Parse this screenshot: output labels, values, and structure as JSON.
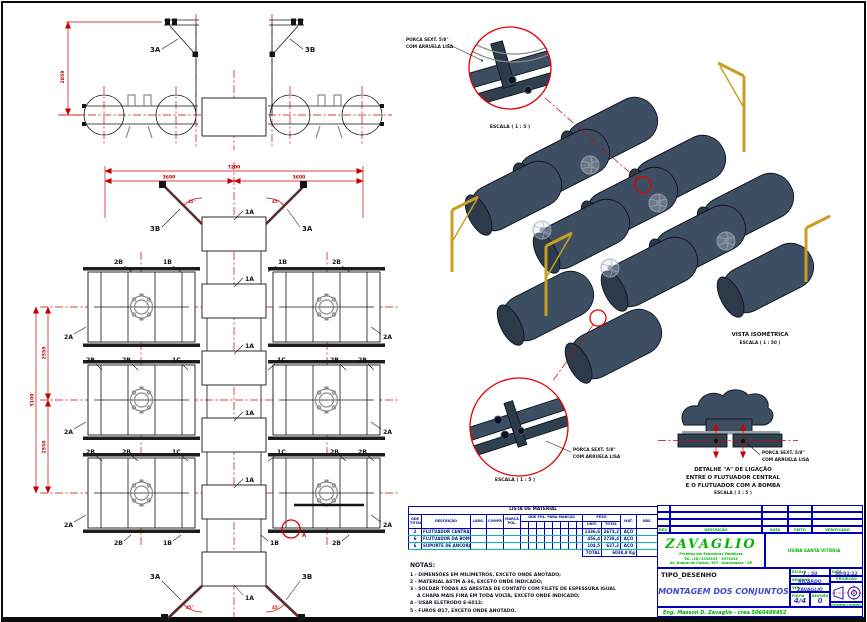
{
  "parts": {
    "a1": "1A",
    "b1": "1B",
    "c1": "1C",
    "a2": "2A",
    "b2": "2B",
    "a3": "3A",
    "b3": "3B"
  },
  "dims": {
    "front_height": "2859",
    "total_width": "7200",
    "half_width": "3600",
    "total_height": "5100",
    "half_height": "2550",
    "angle": "45°",
    "marker_a": "A"
  },
  "callouts": {
    "porca_line1": "PORCA SEXT. 5/8\"",
    "porca_line2": "COM ARRUELA LISA",
    "scale_1_5": "ESCALA ( 1 : 5 )"
  },
  "isometric": {
    "title": "VISTA ISOMÉTRICA",
    "scale": "ESCALA ( 1 : 50 )"
  },
  "detail_a": {
    "title_line1": "DETALHE \"A\" DE LIGAÇÃO",
    "title_line2": "ENTRE O FLUTUADOR CENTRAL",
    "title_line3": "E O FLUTUADOR COM A BOMBA"
  },
  "material_table": {
    "title": "LISTA DE MATERIAL",
    "col_qty": "QDE TOTAL",
    "col_desc": "DESCRIÇÃO",
    "col_larg": "LARG.",
    "col_compr": "COMPR.",
    "col_marca": "MARCA POL.",
    "col_qde_pol": "QDE POL. PARA MARCAS",
    "col_peso": "PESO",
    "col_unit": "UNIT.",
    "col_total": "TOTAL",
    "col_mat": "MAT.",
    "col_obs": "OBS.",
    "rows": [
      {
        "qty": "2",
        "desc": "FLUTUADOR CENTRAL",
        "unit": "1336,6",
        "total": "2673,2",
        "mat": "AÇO"
      },
      {
        "qty": "6",
        "desc": "FLUTUADOR DA BOMBA",
        "unit": "456,4",
        "total": "2738,4",
        "mat": "AÇO"
      },
      {
        "qty": "6",
        "desc": "SUPORTE DE ANCORAGEM",
        "unit": "104,5",
        "total": "627,2",
        "mat": "AÇO"
      }
    ],
    "total_label": "TOTAL",
    "total_value": "6038,8 Kg"
  },
  "notes": {
    "title": "NOTAS:",
    "lines": [
      "1 - DIMENSÕES EM MILÍMETROS, EXCETO ONDE ANOTADO;",
      "2 - MATERIAL ASTM A-36, EXCETO ONDE INDICADO;",
      "3 - SOLDAR TODAS AS ARESTAS DE CONTATO COM FILETE DE ESPESSURA IGUAL",
      "A CHAPA MAIS FINA EM TODA VOLTA, EXCETO ONDE INDICADO;",
      "4 - USAR ELETRODO E-6013;",
      "5 - FUROS Ø17, EXCETO ONDE ANOTADO."
    ]
  },
  "title_block": {
    "col_rev": "REV.",
    "col_desc": "DESCRIÇÃO",
    "col_data": "DATA",
    "col_feito": "FEITO",
    "col_verificado": "VERIFICADO",
    "company": "ZAVAGLIO",
    "company_line1": "Projetos em Estruturas Metálicas",
    "company_line2": "Tel. (16) 3333333 - 9973333",
    "company_line3": "Av. Duque de Caxias, 307 - Araraquara - SP",
    "client": "USINA SANTA VITÓRIA",
    "tipo_label": "TIPO_DESENHO",
    "drawing_title": "MONTAGEM DOS CONJUNTOS",
    "escala_label": "ESCALA",
    "escala_value": "1 : 50",
    "data_label": "DATA",
    "data_value": "30/01/12",
    "desenho_label": "DESENHO",
    "desenho_value": "RICARDO",
    "ver_label": "VER.",
    "ver_value": "ZAVAGLIO",
    "folha_label": "FOLHA",
    "folha_value": "4/4",
    "revisao_label": "REVISÃO",
    "revisao_value": "0",
    "projecao_label": "PROJEÇÃO",
    "diedro_label": "PRIMEIRO DIEDRO",
    "engineer": "Eng. Masson D. Zavaglio - crea 5060488452"
  }
}
